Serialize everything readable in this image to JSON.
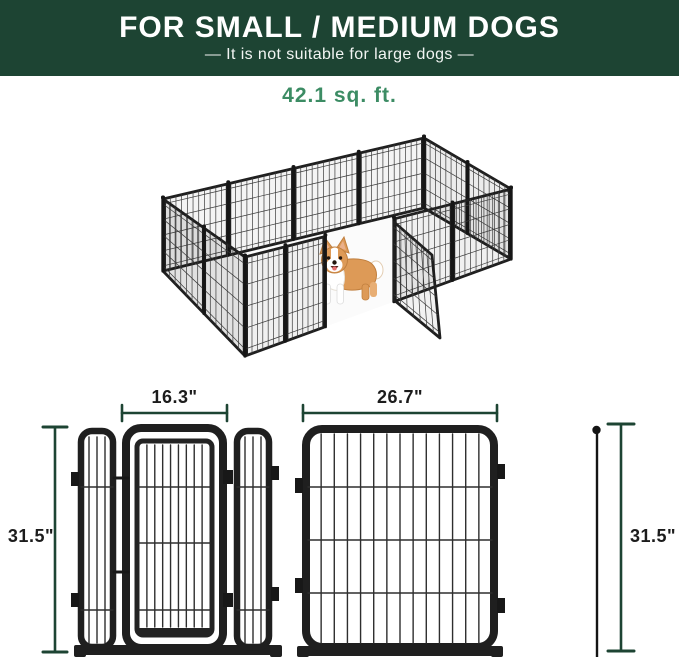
{
  "header": {
    "title": "FOR SMALL / MEDIUM DOGS",
    "subtitle": "—  It is not suitable for large dogs  —"
  },
  "area": {
    "label": "42.1 sq. ft."
  },
  "figure": {
    "description": "12-panel metal wire dog playpen shown in perspective with an open door and a corgi standing inside"
  },
  "dimensions": {
    "door_panel_width": "16.3\"",
    "large_panel_width": "26.7\"",
    "left_height": "31.5\"",
    "right_height": "31.5\""
  },
  "colors": {
    "header_bg": "#1d4433",
    "accent_green": "#3c8c64",
    "measure": "#1d4433",
    "label": "#1c1c1c",
    "metal": "#1f1f1f",
    "wire": "#3a3a3a",
    "dog_tan": "#dd9a57",
    "dog_white": "#ffffff"
  }
}
